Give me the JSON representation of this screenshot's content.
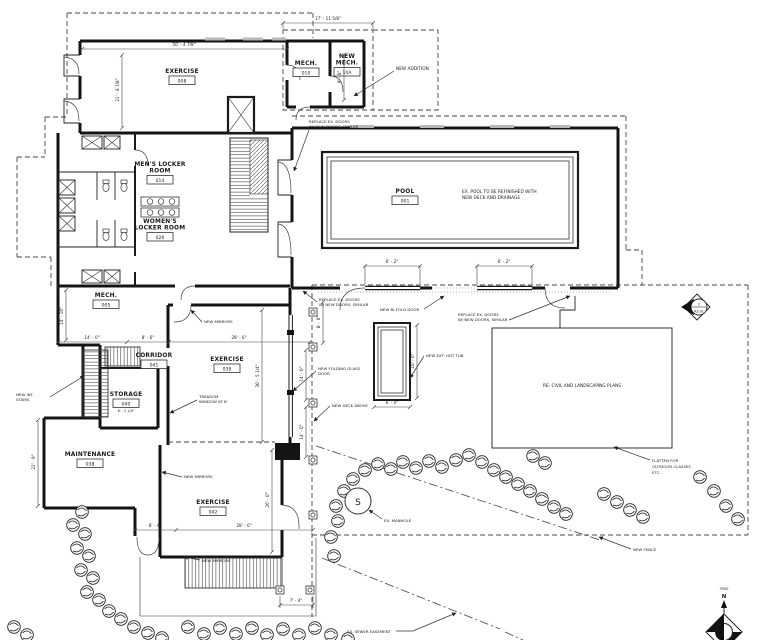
{
  "rooms": {
    "exercise008": {
      "name": "EXERCISE",
      "num": "008"
    },
    "mech010": {
      "name": "MECH.",
      "num": "010"
    },
    "newmech10a": {
      "name1": "NEW",
      "name2": "MECH.",
      "num": "10A"
    },
    "mens014": {
      "name1": "MEN'S LOCKER",
      "name2": "ROOM",
      "num": "014"
    },
    "womens026": {
      "name1": "WOMEN'S",
      "name2": "LOCKER ROOM",
      "num": "026"
    },
    "pool001": {
      "name": "POOL",
      "num": "001"
    },
    "mech005": {
      "name": "MECH.",
      "num": "005"
    },
    "corridor041": {
      "name": "CORRIDOR",
      "num": "041"
    },
    "exercise039": {
      "name": "EXERCISE",
      "num": "039"
    },
    "storage040": {
      "name": "STORAGE",
      "num": "040",
      "dim": "8' - 2 1/4\""
    },
    "maintenance038": {
      "name": "MAINTENANCE",
      "num": "038"
    },
    "exercise042": {
      "name": "EXERCISE",
      "num": "042"
    }
  },
  "annotations": {
    "new_addition": "NEW ADDITION",
    "replace_doors_a": {
      "l1": "REPLACE EX. DOORS",
      "l2": "W/ NEW DOORS, SIMILAR"
    },
    "replace_doors_b": {
      "l1": "REPLACE EX. DOORS",
      "l2": "W/ NEW DOORS, SIMILAR"
    },
    "replace_doors_c": {
      "l1": "REPLACE EX. DOORS",
      "l2": "W/ NEW DOORS, SIMILAR"
    },
    "pool_note": {
      "l1": "EX. POOL TO BE REFINISHED WITH",
      "l2": "NEW DECK AND DRAINAGE"
    },
    "bifold": "NEW BI-FOLD DOOR",
    "mirrors_a": "NEW MIRRORS",
    "mirrors_b": "NEW MIRRORS",
    "mirrors_c": "NEW MIRRORS",
    "folding_glass": {
      "l1": "NEW FOLDING GLASS",
      "l2": "DOOR"
    },
    "hot_tub": "NEW EXT. HOT TUB",
    "deck_above": "NEW DECK ABOVE",
    "transom": {
      "l1": "TRANSOM",
      "l2": "WINDOW AT 8'"
    },
    "int_stairs": {
      "l1": "NEW INT.",
      "l2": "STAIRS"
    },
    "manhole": "EX. MANHOLE",
    "fence": "NEW FENCE",
    "sewer": "EX. SEWER EASEMENT",
    "civil": "RE: CIVIL AND LANDSCAPING PLANS",
    "flatten": {
      "l1": "FLATTEN FOR",
      "l2": "OUTDOOR CLASSES",
      "l3": "ETC."
    }
  },
  "dimensions": {
    "top_addition": "17' - 11 5/8\"",
    "ex008_w": "50' - 4 7/8\"",
    "ex008_h": "21' - 8 7/8\"",
    "mech_h": "9' - 0\"",
    "mech005_h": "14' - 10\"",
    "d14_0": "14' - 0\"",
    "d8_6": "8' - 6\"",
    "d28_6a": "28' - 6\"",
    "ex039_h": "30' - 5 1/4\"",
    "d8_0": "8' - 0\"",
    "deck14a": "14' - 0\"",
    "deck14b": "14' - 0\"",
    "pool_door_a": "6' - 2\"",
    "pool_door_b": "6' - 2\"",
    "tub_h": "10' - 0\"",
    "tub_w": "6' - 0\"",
    "d8_4": "8' - 4\"",
    "d28_6b": "28' - 6\"",
    "ex042_h": "26' - 0\"",
    "maint_h": "22' - 9\"",
    "d7_4": "7' - 4\""
  },
  "markers": {
    "section": {
      "num": "2",
      "sheet": "A3.01"
    },
    "north": {
      "true_label": "TRUE",
      "n_label": "N"
    },
    "manhole_s": "S"
  }
}
